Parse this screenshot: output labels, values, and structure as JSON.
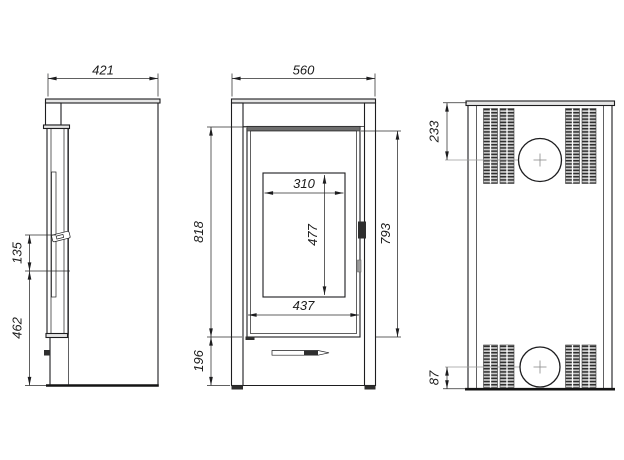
{
  "drawing": {
    "type": "technical-dimension-drawing",
    "subject": "free-standing stove, three orthographic views",
    "background_color": "#ffffff",
    "line_color": "#1d1d1f",
    "views": {
      "side": {
        "dims": {
          "depth": "421",
          "handle_section_height": "135",
          "lower_section_height": "462"
        }
      },
      "front": {
        "dims": {
          "width": "560",
          "door_height": "818",
          "door_panel_height": "793",
          "glass_width": "310",
          "glass_height": "477",
          "door_width": "437",
          "plinth_height": "196"
        }
      },
      "back": {
        "dims": {
          "flue_center_from_top": "233",
          "flue_center_from_bottom": "87"
        }
      }
    }
  }
}
